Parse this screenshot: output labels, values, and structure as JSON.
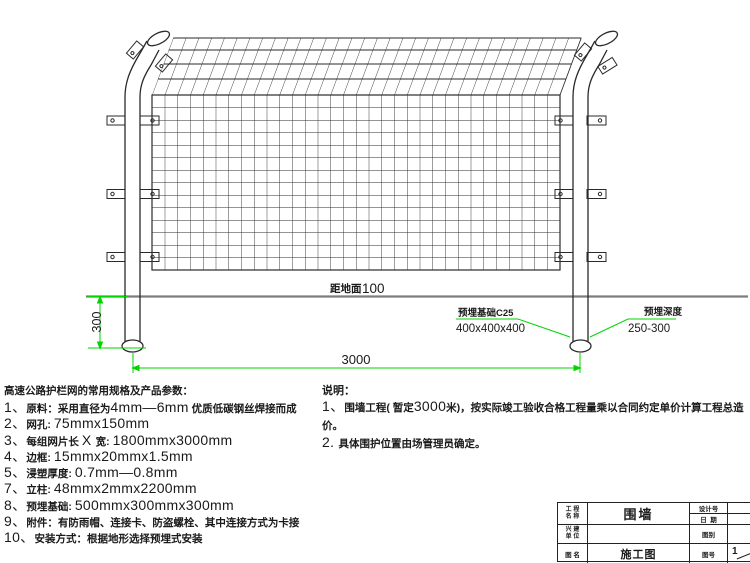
{
  "drawing": {
    "annotations": {
      "ground_label": "距地面",
      "ground_value": "100",
      "dim_buried_depth": "300",
      "dim_span": "3000",
      "foundation_line1": "预埋基础C25",
      "foundation_line2": "400x400x400",
      "embed_line1": "预埋深度",
      "embed_line2": "250-300"
    },
    "colors": {
      "dimension_green": "#00d500",
      "ground_gray": "#7d7d7d",
      "line_black": "#2a2a2a"
    }
  },
  "specs": {
    "title": "高速公路护栏网的常用规格及产品参数：",
    "items": [
      {
        "parts": [
          {
            "t": "1、"
          },
          {
            "t": "原料：采用直径为"
          },
          {
            "t": "4mm—6mm"
          },
          {
            "t": " 优质低碳钢丝焊接而成"
          }
        ]
      },
      {
        "parts": [
          {
            "t": "2、"
          },
          {
            "t": "网孔: "
          },
          {
            "t": "75mmx150mm"
          }
        ]
      },
      {
        "parts": [
          {
            "t": "3、"
          },
          {
            "t": "每组网片长 "
          },
          {
            "t": "X "
          },
          {
            "t": "宽: "
          },
          {
            "t": "1800mmx3000mm"
          }
        ]
      },
      {
        "parts": [
          {
            "t": "4、"
          },
          {
            "t": "边框: "
          },
          {
            "t": "15mmx20mmx1.5mm"
          }
        ]
      },
      {
        "parts": [
          {
            "t": "5、"
          },
          {
            "t": "浸塑厚度: "
          },
          {
            "t": "0.7mm—0.8mm"
          }
        ]
      },
      {
        "parts": [
          {
            "t": "7、"
          },
          {
            "t": "立柱: "
          },
          {
            "t": "48mmx2mmx2200mm"
          }
        ]
      },
      {
        "parts": [
          {
            "t": "8、"
          },
          {
            "t": "预埋基础: "
          },
          {
            "t": "500mmx300mmx300mm"
          }
        ]
      },
      {
        "parts": [
          {
            "t": "9、"
          },
          {
            "t": "附件：有防雨帽、连接卡、防盗螺栓、其中连接方式为卡接"
          }
        ]
      },
      {
        "parts": [
          {
            "t": "10、"
          },
          {
            "t": "安装方式：根据地形选择预埋式安装"
          }
        ]
      }
    ]
  },
  "notes": {
    "heading": "说明：",
    "note1": {
      "parts": [
        {
          "t": "1、"
        },
        {
          "t": "围墙工程( 暂定"
        },
        {
          "t": "3000"
        },
        {
          "t": "米)，按实际竣工验收合格工程量乘以合同约定单价计算工程总造价。"
        }
      ]
    },
    "note2": {
      "parts": [
        {
          "t": "2. "
        },
        {
          "t": "具体围护位置由场管理员确定。"
        }
      ]
    }
  },
  "titleblock": {
    "project_label_l1": "工 程",
    "project_label_l2": "名 称",
    "project_value": "围墙",
    "design_no_label": "设计号",
    "design_no_value": "",
    "date_label": "日  期",
    "date_value": "",
    "builder_label_l1": "兴 建",
    "builder_label_l2": "单 位",
    "builder_value": "",
    "category_label": "图别",
    "category_value": "",
    "name_label": "图 名",
    "name_value": "施工图",
    "number_label": "图号",
    "number_value": "1"
  }
}
